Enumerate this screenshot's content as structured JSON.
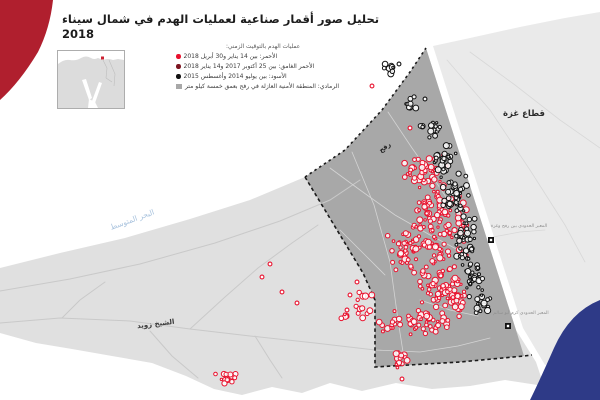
{
  "header": {
    "title_ar": "تحليل صور أقمار صناعية لعمليات الهدم في شمال سيناء",
    "title_year": "2018"
  },
  "legend": {
    "header": "عمليات الهدم بالتوقيت الزمني:",
    "items": [
      {
        "swatch": "dot",
        "color": "#e8112d",
        "label": "الأحمر: بين 14 يناير و30 أبريل 2018"
      },
      {
        "swatch": "dot",
        "color": "#7c1420",
        "label": "الأحمر الغامق: بين 25 أكتوبر 2017 و14 يناير 2018"
      },
      {
        "swatch": "dot",
        "color": "#111111",
        "label": "الأسود: بين يوليو 2014 وأغسطس 2015"
      },
      {
        "swatch": "square",
        "color": "#a8a8a8",
        "label": "الرمادي: المنطقة الأمنية العازلة في رفح بعمق خمسة كيلو متر"
      }
    ]
  },
  "inset": {
    "land": "M0,13 Q6,8 12,9 Q18,10 23,7 Q28,4 33,7 Q36,9 40,7 L45,9 Q50,7 55,9 L60,8 L66,9 L66,57 L0,57 Z",
    "water": [
      "M24,29 L28,28 L34,47 L31,49 Z",
      "M41,31 L44,32 L37,52 L34,50 Z",
      "M31,48 L37,51 L40,57 L30,57 Z"
    ],
    "borders": [
      "M45,9 L49,17 L48,27",
      "M51,9 L57,23 L56,35",
      "M48,27 L54,31"
    ],
    "marker": {
      "x": 43,
      "y": 5.5,
      "w": 3,
      "h": 3,
      "color": "#cc2233"
    },
    "land_color": "#dcdcdc",
    "border_color": "#bdbdbd"
  },
  "map": {
    "colors": {
      "land_egypt": "#e0e0e0",
      "land_gaza": "#eaeaea",
      "buffer": "#a8a8a8",
      "road_egypt": "#c9c9c9",
      "road_buffer": "#d4d4d4",
      "road_gaza": "#d8d8d8",
      "dash": "#1a1a1a",
      "red": "#e8112d",
      "black": "#111111",
      "crimson": "#b01f2e",
      "navy": "#2e3a87",
      "sea_label": "#a9c3de"
    },
    "paths": {
      "land_egypt": "M0,268 L60,253 L125,238 L190,219 L250,200 L305,177 L345,150 L382,110 L410,72 L426,48 L516,330 L536,362 L544,386 L505,380 L470,386 L432,389 L396,383 L362,391 L330,383 L302,393 L272,387 L242,395 L214,389 L186,376 L152,363 L112,356 L72,349 L36,343 L0,333 Z",
      "land_gaza": "M433,46 L470,38 L520,27 L565,18 L600,12 L600,340 L545,365 L523,328 Z",
      "buffer_zone": "M305,177 L345,150 L382,110 L410,72 L426,48 L516,330 L524,356 L460,362 L375,367 L375,300 L363,273 Z",
      "boundary_dashed": "M305,177 L363,273 L375,300 L375,367 L460,362 L524,356 L532,355",
      "coast_dashed": "M305,177 L345,150 L382,110 L410,72 L426,48",
      "blob_crimson": "M0,0 L53,0 Q50,28 38,52 Q20,82 0,100 Z",
      "blob_navy": "M600,300 Q570,312 554,348 Q538,384 530,400 L600,400 Z"
    },
    "roads_egypt": [
      "M0,291 L70,279 L140,264 L215,243 L280,221 L330,200 L360,180",
      "M0,323 L60,318 L130,321 L190,329 L250,336 L315,343 L375,350",
      "M190,329 L225,297 L258,268 L292,243 L318,225",
      "M150,331 L172,356 L198,378",
      "M62,318 L80,300 L105,282",
      "M255,336 L270,360 L282,378"
    ],
    "roads_buffer": [
      "M330,168 L360,190 L395,215 L430,235 L462,252",
      "M352,152 L374,205 L390,262 L398,320 L403,352",
      "M388,112 L412,148 L436,182 L452,206",
      "M375,350 L420,352 L458,346 L490,338",
      "M340,230 L365,255 L385,275",
      "M420,300 L450,310 L478,316"
    ],
    "roads_gaza": [
      "M447,60 L490,110 L530,170 L565,225 L585,262",
      "M470,52 L515,85 L560,120 L600,148",
      "M493,237 L520,232 L545,230"
    ],
    "clusters_red": [
      [
        425,
        170,
        24,
        20,
        45
      ],
      [
        437,
        206,
        26,
        24,
        55
      ],
      [
        428,
        246,
        30,
        26,
        60
      ],
      [
        438,
        286,
        28,
        22,
        55
      ],
      [
        428,
        320,
        26,
        16,
        42
      ],
      [
        400,
        253,
        14,
        22,
        22
      ],
      [
        457,
        233,
        13,
        34,
        30
      ],
      [
        452,
        299,
        15,
        18,
        24
      ],
      [
        390,
        322,
        18,
        13,
        14
      ],
      [
        398,
        361,
        11,
        9,
        14
      ],
      [
        363,
        304,
        13,
        17,
        12
      ],
      [
        344,
        317,
        7,
        7,
        6
      ],
      [
        228,
        378,
        16,
        7,
        14
      ]
    ],
    "dots_red": [
      [
        270,
        264
      ],
      [
        282,
        292
      ],
      [
        297,
        303
      ],
      [
        262,
        277
      ],
      [
        350,
        295
      ],
      [
        357,
        282
      ],
      [
        347,
        310
      ],
      [
        402,
        379
      ],
      [
        410,
        128
      ],
      [
        372,
        86
      ]
    ],
    "clusters_black": [
      [
        444,
        158,
        13,
        22,
        30
      ],
      [
        455,
        196,
        14,
        26,
        38
      ],
      [
        466,
        240,
        14,
        28,
        40
      ],
      [
        476,
        280,
        12,
        20,
        28
      ],
      [
        484,
        305,
        9,
        12,
        16
      ],
      [
        434,
        130,
        8,
        10,
        12
      ],
      [
        388,
        68,
        6,
        8,
        8
      ],
      [
        410,
        103,
        7,
        7,
        8
      ],
      [
        421,
        126,
        4,
        4,
        4
      ]
    ],
    "dots_black": [
      [
        399,
        64
      ],
      [
        425,
        99
      ]
    ],
    "crossings": [
      {
        "x": 491,
        "y": 240
      },
      {
        "x": 508,
        "y": 326
      }
    ],
    "labels": [
      {
        "name": "label-gaza-strip",
        "text": "قطاع غزة",
        "x": 524,
        "y": 116,
        "size": 8.5,
        "weight": "bold",
        "color": "#2b2b2b",
        "rotate": 0,
        "spacing": 0
      },
      {
        "name": "label-rafah",
        "text": "رفح",
        "x": 386,
        "y": 149,
        "size": 6.5,
        "weight": "bold",
        "color": "#222222",
        "rotate": -36,
        "spacing": 0
      },
      {
        "name": "label-sheikh-zuweid",
        "text": "الشيخ زويد",
        "x": 156,
        "y": 326,
        "size": 7,
        "weight": "bold",
        "color": "#3a3a3a",
        "rotate": -7,
        "spacing": 0
      },
      {
        "name": "label-mediterranean-sea",
        "text": "البحر المتوسط",
        "x": 133,
        "y": 222,
        "size": 7.5,
        "weight": "normal",
        "color": "#a9c3de",
        "rotate": -20,
        "spacing": 0.6
      },
      {
        "name": "label-rafah-crossing",
        "text": "المعبر الحدودي بين رفح وغزة",
        "x": 519,
        "y": 227,
        "size": 4.6,
        "weight": "normal",
        "color": "#8f8f8f",
        "rotate": 0,
        "spacing": 0
      },
      {
        "name": "label-kerem-shalom-crossing",
        "text": "المعبر الحدودي كرم أبو سالم",
        "x": 521,
        "y": 314,
        "size": 4.6,
        "weight": "normal",
        "color": "#8f8f8f",
        "rotate": 0,
        "spacing": 0
      }
    ]
  }
}
